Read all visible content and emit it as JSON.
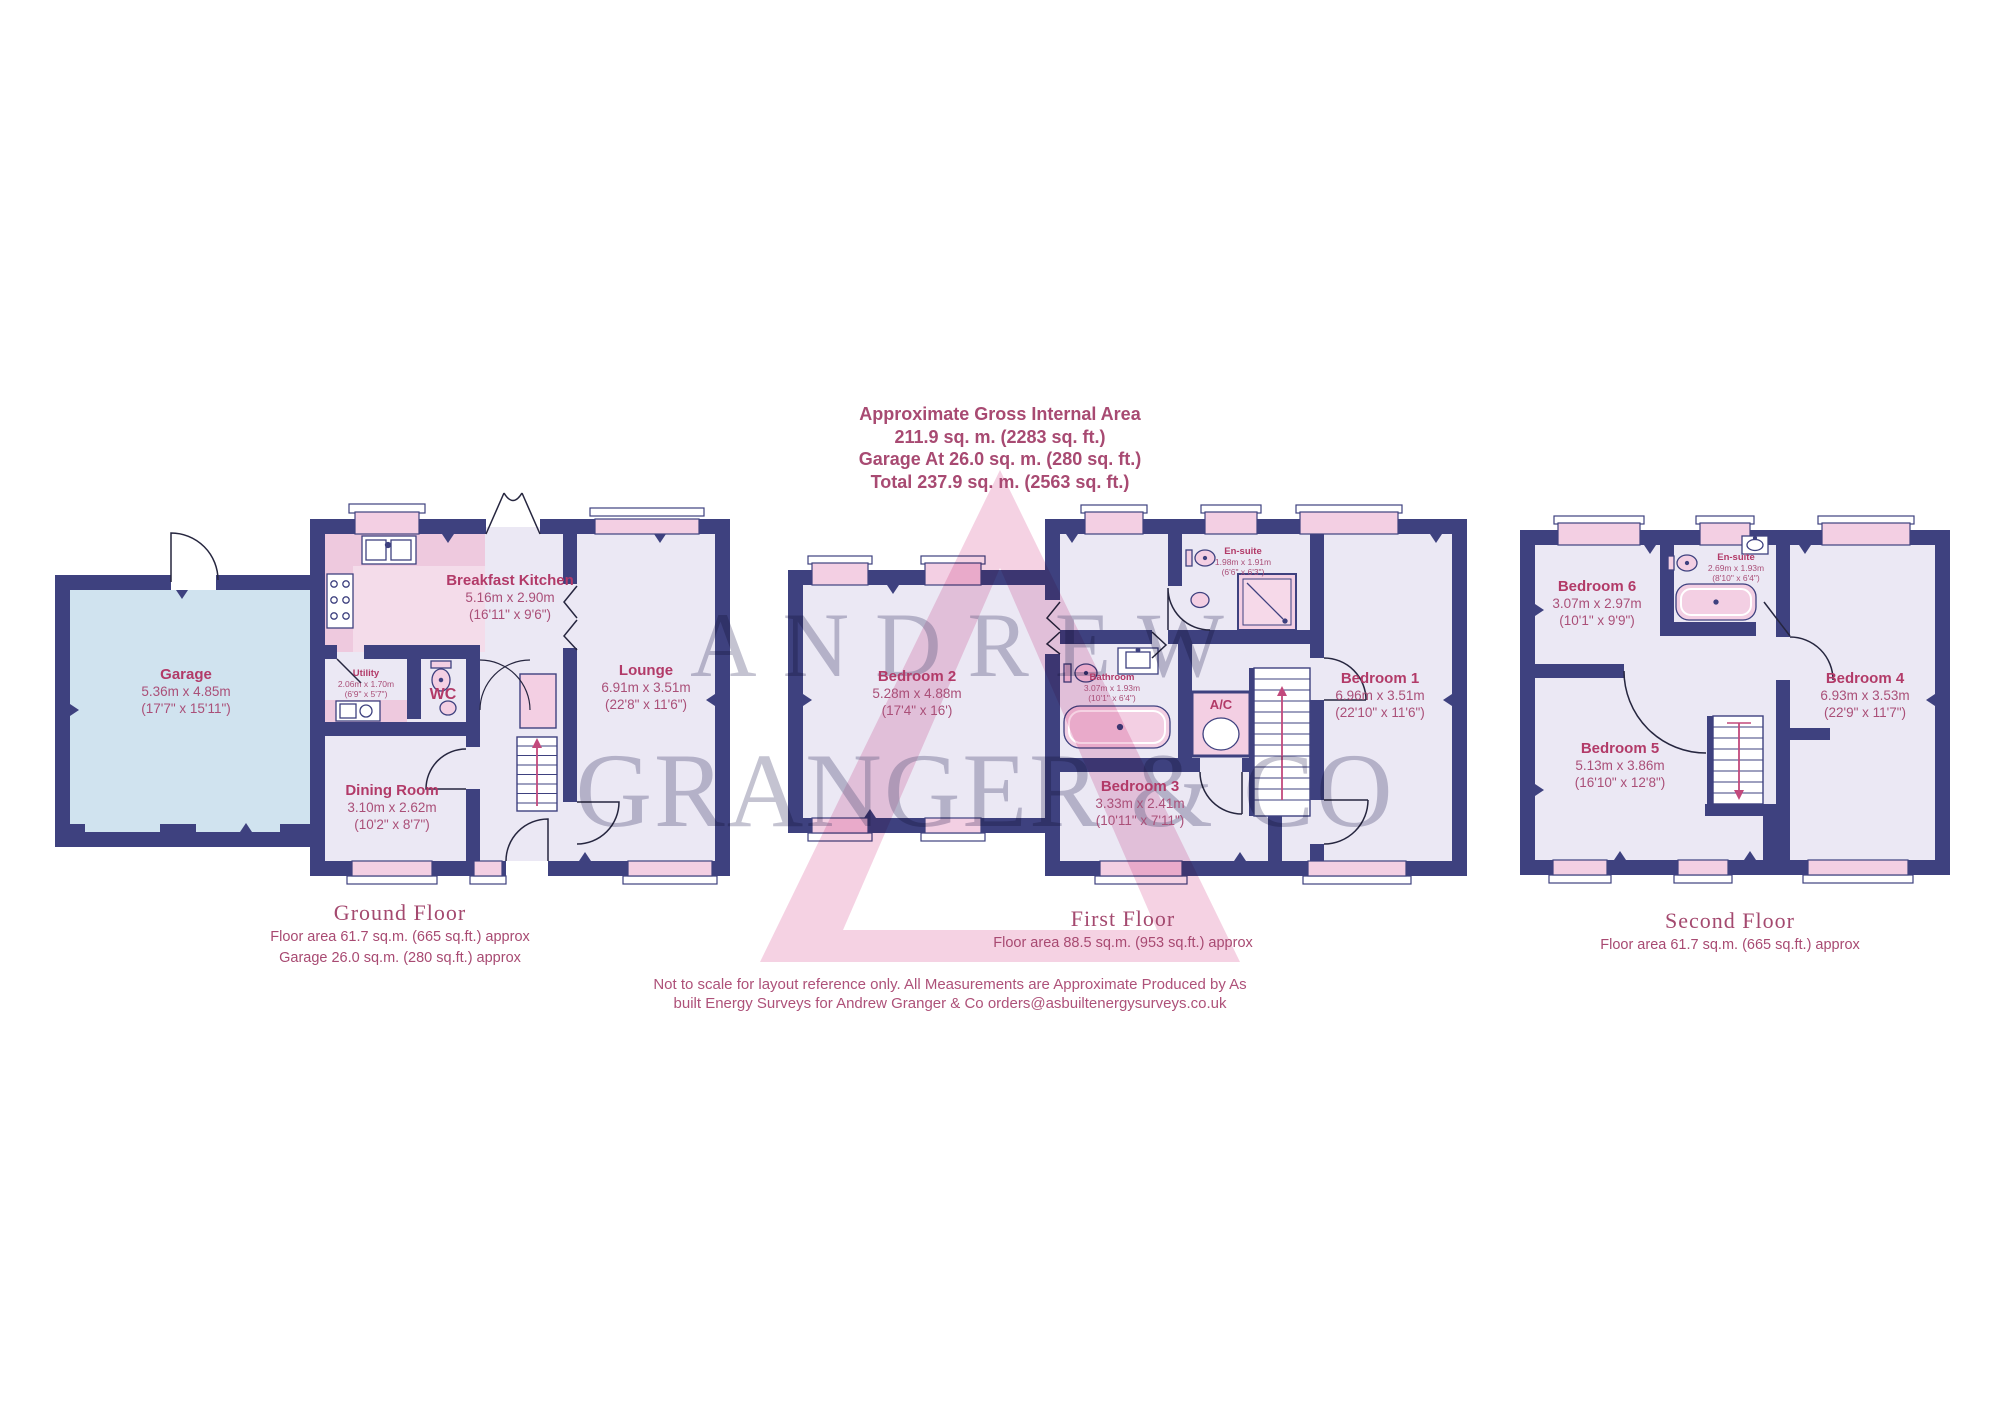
{
  "header": {
    "lines": [
      "Approximate Gross Internal Area",
      "211.9 sq. m. (2283 sq. ft.)",
      "Garage At 26.0 sq. m. (280 sq. ft.)",
      "Total 237.9 sq. m. (2563 sq. ft.)"
    ]
  },
  "watermark": {
    "line1": "ANDREW",
    "line2": "GRANGER & CO"
  },
  "floors": [
    {
      "caption": {
        "title": "Ground Floor",
        "lines": [
          "Floor area 61.7 sq.m. (665 sq.ft.) approx",
          "Garage 26.0 sq.m. (280 sq.ft.) approx"
        ]
      },
      "rooms": [
        {
          "name": "Garage",
          "metric": "5.36m x 4.85m",
          "imperial": "(17'7\" x 15'11\")"
        },
        {
          "name": "Breakfast Kitchen",
          "metric": "5.16m x 2.90m",
          "imperial": "(16'11\" x 9'6\")"
        },
        {
          "name": "Utility",
          "metric": "2.06m x 1.70m",
          "imperial": "(6'9\" x 5'7\")"
        },
        {
          "name": "WC"
        },
        {
          "name": "Dining Room",
          "metric": "3.10m x 2.62m",
          "imperial": "(10'2\" x 8'7\")"
        },
        {
          "name": "Lounge",
          "metric": "6.91m x 3.51m",
          "imperial": "(22'8\" x 11'6\")"
        }
      ]
    },
    {
      "caption": {
        "title": "First Floor",
        "lines": [
          "Floor area 88.5 sq.m. (953 sq.ft.) approx"
        ]
      },
      "rooms": [
        {
          "name": "Bedroom 2",
          "metric": "5.28m x 4.88m",
          "imperial": "(17'4\" x 16')"
        },
        {
          "name": "En-suite",
          "metric": "1.98m x 1.91m",
          "imperial": "(6'6\" x 6'3\")"
        },
        {
          "name": "Bedroom 1",
          "metric": "6.96m x 3.51m",
          "imperial": "(22'10\" x 11'6\")"
        },
        {
          "name": "Bathroom",
          "metric": "3.07m x 1.93m",
          "imperial": "(10'1\" x 6'4\")"
        },
        {
          "name": "A/C"
        },
        {
          "name": "Bedroom 3",
          "metric": "3.33m x 2.41m",
          "imperial": "(10'11\" x 7'11\")"
        }
      ]
    },
    {
      "caption": {
        "title": "Second Floor",
        "lines": [
          "Floor area 61.7 sq.m. (665 sq.ft.) approx"
        ]
      },
      "rooms": [
        {
          "name": "Bedroom 6",
          "metric": "3.07m x 2.97m",
          "imperial": "(10'1\" x 9'9\")"
        },
        {
          "name": "En-suite",
          "metric": "2.69m x 1.93m",
          "imperial": "(8'10\" x 6'4\")"
        },
        {
          "name": "Bedroom 4",
          "metric": "6.93m x 3.53m",
          "imperial": "(22'9\" x 11'7\")"
        },
        {
          "name": "Bedroom 5",
          "metric": "5.13m x 3.86m",
          "imperial": "(16'10\" x 12'8\")"
        }
      ]
    }
  ],
  "disclaimer": {
    "lines": [
      "Not to scale for layout reference only. All Measurements are Approximate Produced by As",
      "built Energy Surveys for Andrew Granger & Co orders@asbuiltenergysurveys.co.uk"
    ]
  },
  "colors": {
    "wall": "#3e417f",
    "room_fill": "#ebe8f4",
    "window_pink": "#f3cfe3",
    "fixture_pink": "#eec9de",
    "garage_fill": "#d0e3ef",
    "accent_text": "#a84a72",
    "room_name_text": "#b23a68",
    "watermark_text": "#6c698c",
    "logo_pink": "#f5d2e3"
  }
}
